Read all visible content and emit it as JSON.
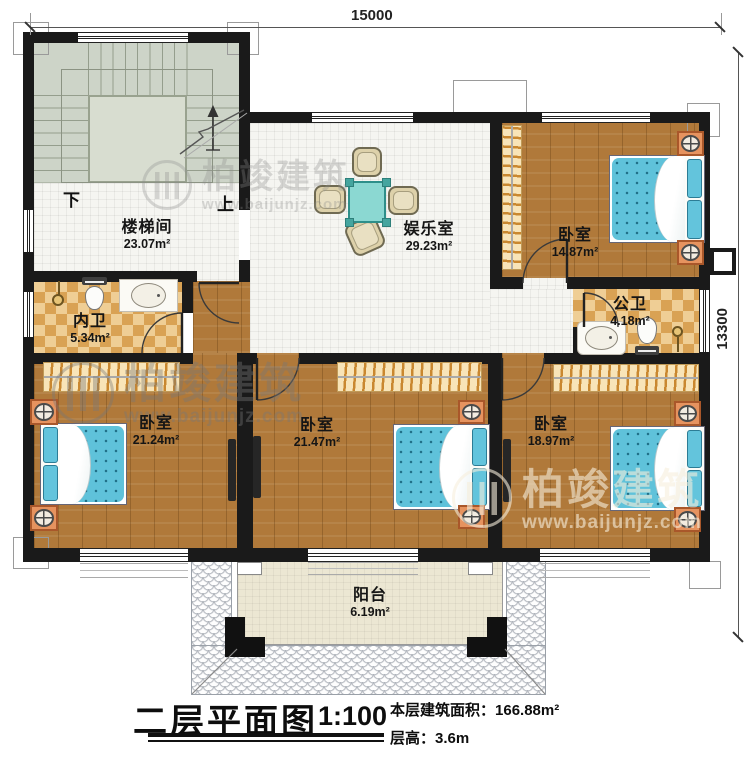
{
  "title_block": {
    "title": "二层平面图",
    "scale": "1:100",
    "area_label": "本层建筑面积：",
    "area_value": "166.88m²",
    "height_label": "层高：",
    "height_value": "3.6m"
  },
  "dimensions": {
    "width_mm": "15000",
    "height_mm": "13300"
  },
  "stairs": {
    "down_label": "下",
    "up_label": "上"
  },
  "rooms": {
    "stairwell": {
      "name": "楼梯间",
      "area": "23.07m²"
    },
    "entertainment": {
      "name": "娱乐室",
      "area": "29.23m²"
    },
    "bedroom_ne": {
      "name": "卧室",
      "area": "14.87m²"
    },
    "bath_inner": {
      "name": "内卫",
      "area": "5.34m²"
    },
    "bath_public": {
      "name": "公卫",
      "area": "4.18m²"
    },
    "bedroom_sw": {
      "name": "卧室",
      "area": "21.24m²"
    },
    "bedroom_s": {
      "name": "卧室",
      "area": "21.47m²"
    },
    "bedroom_se": {
      "name": "卧室",
      "area": "18.97m²"
    },
    "balcony": {
      "name": "阳台",
      "area": "6.19m²"
    }
  },
  "watermark": {
    "brand": "柏竣建筑",
    "url": "www.baijunjz.com"
  },
  "colors": {
    "wall": "#1a1a1a",
    "wood_floor": "#b0793a",
    "bath_tile": "#d9a254",
    "stair_floor": "#cdd4c8",
    "bed_blue": "#5fc2da",
    "table_teal": "#8bd8d2",
    "nightstand_orange": "#e6935f",
    "wardrobe_tan": "#f8e4b8"
  }
}
